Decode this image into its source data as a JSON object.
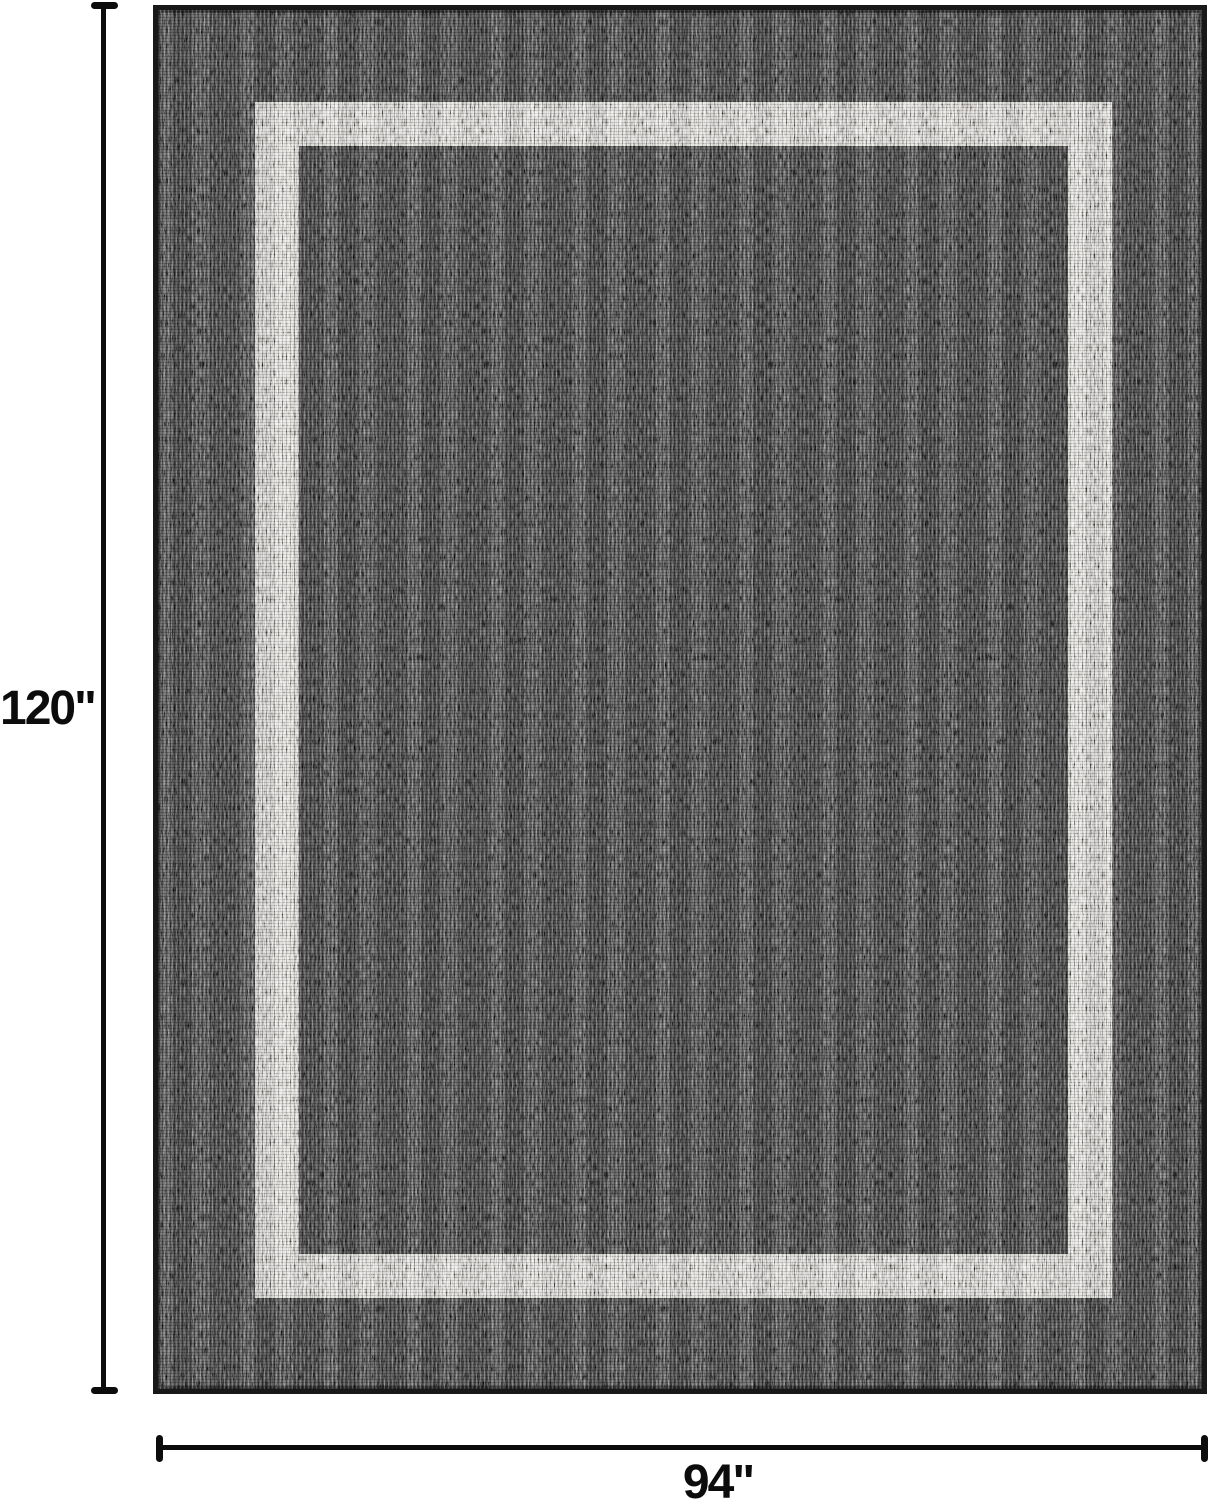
{
  "figure": {
    "type": "product-dimension-image",
    "subject": "bordered flatweave area rug, charcoal field with light gray border band",
    "height_label": "120\"",
    "width_label": "94\""
  },
  "colors": {
    "background": "#ffffff",
    "rug_field": "#4a4a4a",
    "rug_edge": "#181818",
    "border_band": "#d8d6d0",
    "dimension_lines": "#0c0c0c"
  }
}
